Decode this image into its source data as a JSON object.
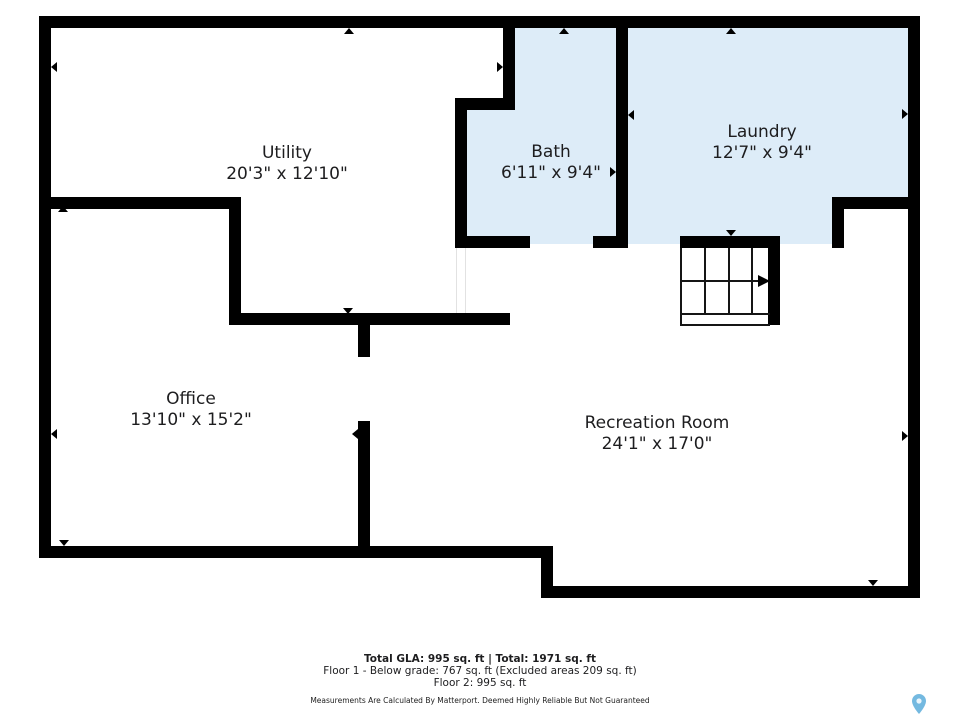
{
  "floorplan": {
    "rooms": [
      {
        "id": "utility",
        "name": "Utility",
        "dimensions": "20'3\" x 12'10\"",
        "highlighted": false
      },
      {
        "id": "bath",
        "name": "Bath",
        "dimensions": "6'11\" x 9'4\"",
        "highlighted": true
      },
      {
        "id": "laundry",
        "name": "Laundry",
        "dimensions": "12'7\" x 9'4\"",
        "highlighted": true
      },
      {
        "id": "office",
        "name": "Office",
        "dimensions": "13'10\" x 15'2\"",
        "highlighted": false
      },
      {
        "id": "recreation-room",
        "name": "Recreation Room",
        "dimensions": "24'1\" x 17'0\"",
        "highlighted": false
      }
    ],
    "icons": {
      "stairs_direction": "right-arrow",
      "branding": "location-pin-icon"
    },
    "colors": {
      "wall": "#000000",
      "room_highlight": "#ddecf8",
      "matterport_pin": "#74b9e0",
      "text": "#1d1d1f"
    }
  },
  "footer": {
    "totals": "Total GLA: 995 sq. ft | Total: 1971 sq. ft",
    "floor1": "Floor 1 - Below grade: 767 sq. ft (Excluded areas 209 sq. ft)",
    "floor2": "Floor 2: 995 sq. ft",
    "disclaimer": "Measurements Are Calculated By Matterport. Deemed Highly Reliable But Not Guaranteed"
  }
}
